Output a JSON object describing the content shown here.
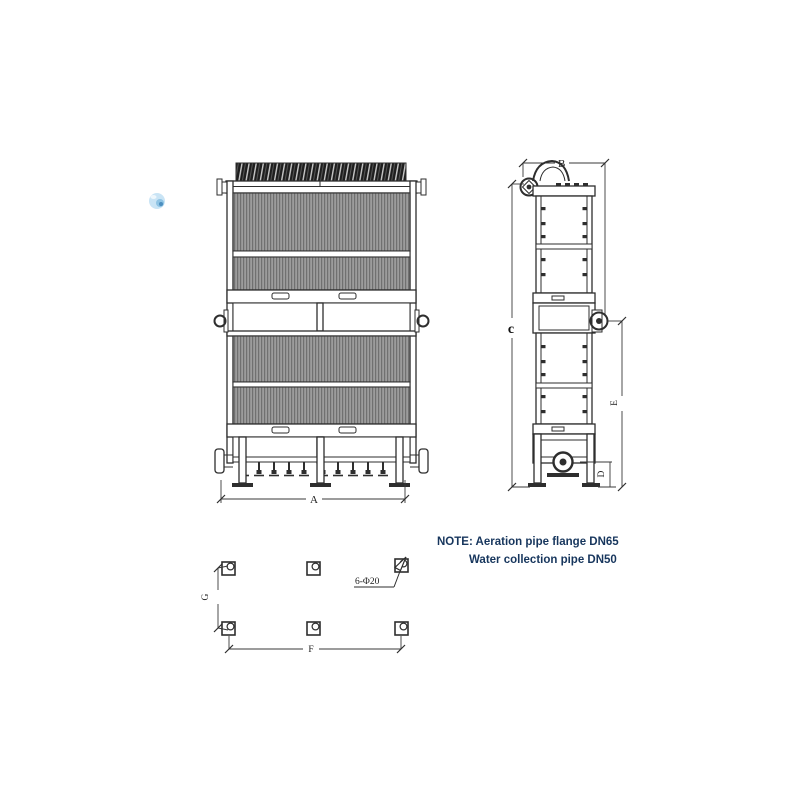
{
  "title": "MBR flat sheet membrane module drawing",
  "colors": {
    "line": "#2e2e2e",
    "membrane_fill": "#9c9c9c",
    "membrane_stripe": "#707070",
    "note_text": "#17365d",
    "watermark_blue": "#c9e4f5"
  },
  "front_view": {
    "dim_a_label": "A"
  },
  "side_view": {
    "dim_b_label": "B",
    "dim_c_label": "c",
    "dim_e_label": "E",
    "dim_d_label": "D"
  },
  "plan_view": {
    "dim_g_label": "G",
    "dim_f_label": "F",
    "holes_label": "6-Φ20"
  },
  "note": {
    "prefix_line": "NOTE: Aeration pipe flange DN65",
    "second_line": "Water collection pipe DN50"
  }
}
